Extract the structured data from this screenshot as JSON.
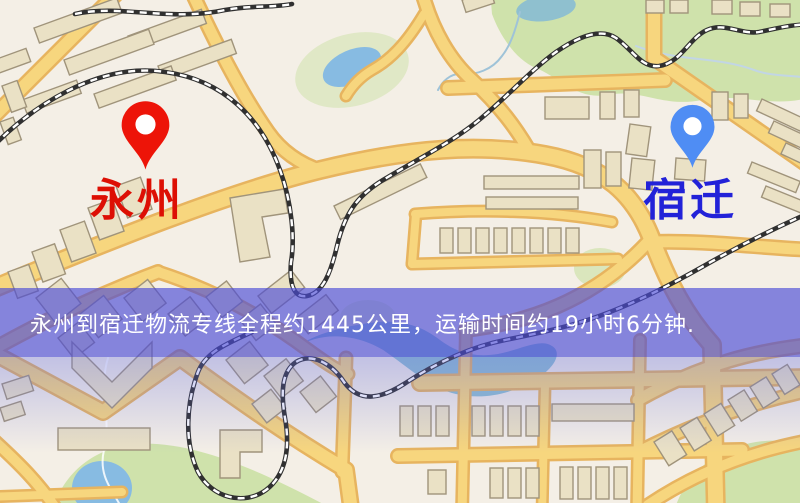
{
  "banner": {
    "text": "永州到宿迁物流专线全程约1445公里，运输时间约19小时6分钟.",
    "distance_km": "1445",
    "duration_hours": "19",
    "duration_minutes": "6",
    "text_color": "#ffffff",
    "overlay_color": "rgba(76,76,214,0.66)"
  },
  "origin_marker": {
    "label": "永州",
    "pin_color": "#ed1408",
    "label_color": "#dd0f04"
  },
  "destination_marker": {
    "label": "宿迁",
    "pin_color": "#4f8df4",
    "label_color": "#2222d8"
  },
  "map_colors": {
    "bg": "#f4efe6",
    "road_fill": "#f7d67e",
    "road_casing": "#e7b45f",
    "park": "#cfe2ab",
    "water": "#87bbe2",
    "water2": "#8fc0cf",
    "building_fill": "#eae1c5",
    "building_stroke": "#a0947b",
    "railway": "#303030",
    "tint": "rgba(100,108,224,0.35)"
  }
}
